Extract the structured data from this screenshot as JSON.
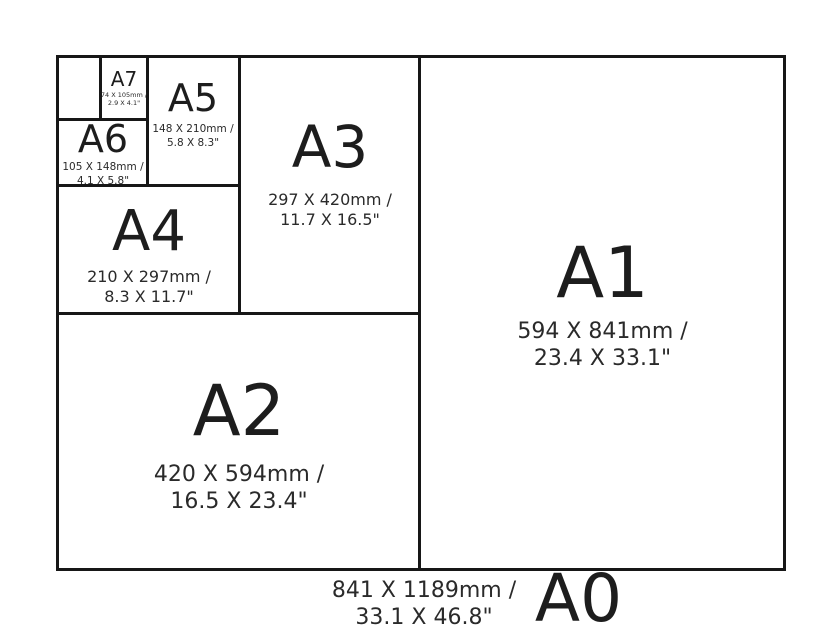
{
  "diagram": {
    "name": "A-series paper size comparison chart",
    "colors": {
      "line": "#171717",
      "text": "#1d1d1d",
      "background": "#ffffff"
    },
    "sizes": {
      "a0": {
        "label": "A0",
        "dims_mm": "841 X 1189mm /",
        "dims_in": "33.1 X 46.8\""
      },
      "a1": {
        "label": "A1",
        "dims_mm": "594 X 841mm /",
        "dims_in": "23.4 X 33.1\""
      },
      "a2": {
        "label": "A2",
        "dims_mm": "420 X 594mm /",
        "dims_in": "16.5 X 23.4\""
      },
      "a3": {
        "label": "A3",
        "dims_mm": "297 X 420mm /",
        "dims_in": "11.7 X 16.5\""
      },
      "a4": {
        "label": "A4",
        "dims_mm": "210 X 297mm /",
        "dims_in": "8.3 X 11.7\""
      },
      "a5": {
        "label": "A5",
        "dims_mm": "148 X 210mm /",
        "dims_in": "5.8 X 8.3\""
      },
      "a6": {
        "label": "A6",
        "dims_mm": "105 X 148mm /",
        "dims_in": "4.1 X 5.8\""
      },
      "a7": {
        "label": "A7",
        "dims_mm": "74 X 105mm /",
        "dims_in": "2.9 X 4.1\""
      }
    }
  }
}
